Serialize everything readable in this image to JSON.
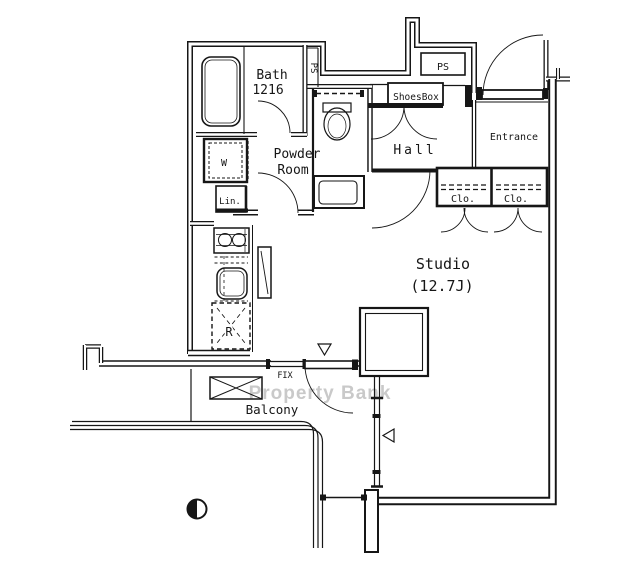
{
  "plan": {
    "watermark": "Property Bank",
    "rooms": {
      "bath": {
        "name": "Bath",
        "dimension": "1216"
      },
      "powder_room": {
        "line1": "Powder",
        "line2": "Room"
      },
      "hall": "Hall",
      "entrance": "Entrance",
      "studio": {
        "name": "Studio",
        "size": "(12.7J)"
      },
      "balcony": "Balcony"
    },
    "labels": {
      "ps_shaft_bath": "PS",
      "ps_shaft_entry": "PS",
      "shoes_box": "ShoesBox",
      "closet_left": "Clo.",
      "closet_right": "Clo.",
      "washer": "W",
      "linen": "Lin.",
      "refrigerator": "R",
      "fix_window": "FIX"
    },
    "colors": {
      "ink": "#161616",
      "watermark": "#c9c9c9",
      "background": "#ffffff"
    }
  }
}
